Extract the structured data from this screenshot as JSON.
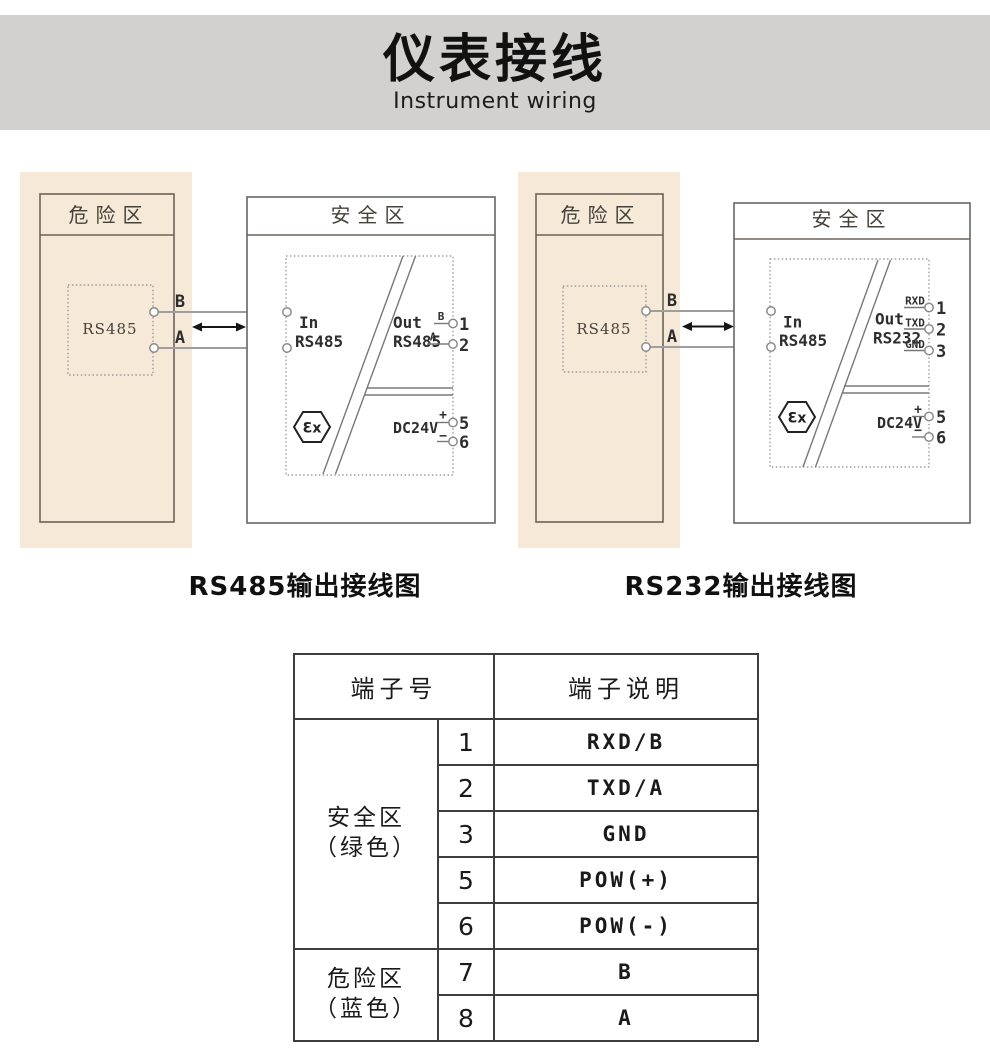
{
  "header": {
    "title": "仪表接线",
    "subtitle": "Instrument wiring"
  },
  "colors": {
    "band-gray": "#d2d1d0",
    "hazard-beige": "#f7e9d7"
  },
  "diagrams": [
    {
      "caption": "RS485输出接线图",
      "danger_zone_label": "危险区",
      "safe_zone_label": "安全区",
      "device_label": "RS485",
      "wire_labels": {
        "top": "B",
        "bottom": "A"
      },
      "input": {
        "terminal_top": "7",
        "terminal_bottom": "8",
        "label": "In",
        "type": "RS485"
      },
      "output": {
        "label": "Out",
        "type": "RS485",
        "terminals": [
          {
            "signal": "B",
            "number": "1"
          },
          {
            "signal": "A",
            "number": "2"
          }
        ]
      },
      "power": {
        "label": "DC24V",
        "terminals": [
          {
            "signal": "+",
            "number": "5"
          },
          {
            "signal": "−",
            "number": "6"
          }
        ]
      },
      "ex_mark": "Ɛx"
    },
    {
      "caption": "RS232输出接线图",
      "danger_zone_label": "危险区",
      "safe_zone_label": "安全区",
      "device_label": "RS485",
      "wire_labels": {
        "top": "B",
        "bottom": "A"
      },
      "input": {
        "terminal_top": "7",
        "terminal_bottom": "8",
        "label": "In",
        "type": "RS485"
      },
      "output": {
        "label": "Out",
        "type": "RS232",
        "terminals": [
          {
            "signal": "RXD",
            "number": "1"
          },
          {
            "signal": "TXD",
            "number": "2"
          },
          {
            "signal": "GND",
            "number": "3"
          }
        ]
      },
      "power": {
        "label": "DC24V",
        "terminals": [
          {
            "signal": "+",
            "number": "5"
          },
          {
            "signal": "−",
            "number": "6"
          }
        ]
      },
      "ex_mark": "Ɛx"
    }
  ],
  "table": {
    "headers": [
      "端子号",
      "端子说明"
    ],
    "groups": [
      {
        "zone": "安全区",
        "color_note": "（绿色）",
        "rows": [
          [
            "1",
            "RXD/B"
          ],
          [
            "2",
            "TXD/A"
          ],
          [
            "3",
            "GND"
          ],
          [
            "5",
            "POW(+)"
          ],
          [
            "6",
            "POW(-)"
          ]
        ]
      },
      {
        "zone": "危险区",
        "color_note": "（蓝色）",
        "rows": [
          [
            "7",
            "B"
          ],
          [
            "8",
            "A"
          ]
        ]
      }
    ]
  }
}
